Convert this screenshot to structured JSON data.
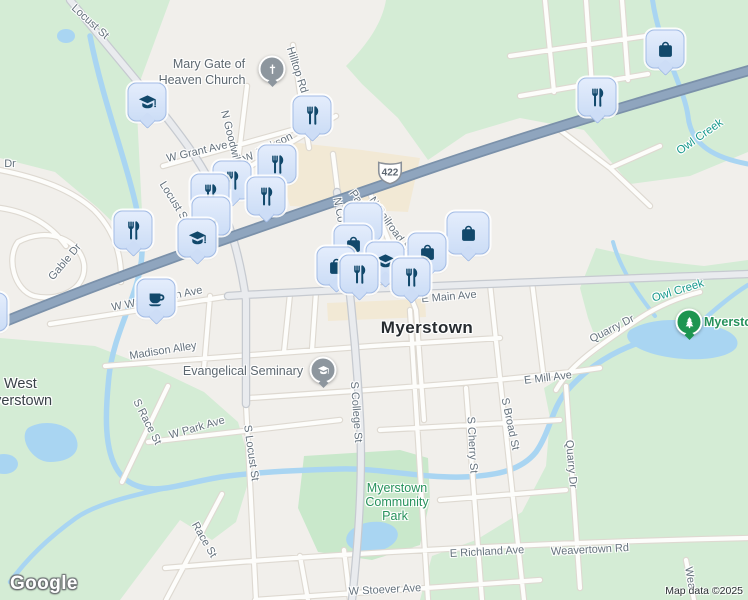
{
  "attribution": {
    "google": "Google",
    "map_data": "Map data ©2025"
  },
  "route_shield": {
    "number": "422",
    "x": 390,
    "y": 172
  },
  "colors": {
    "background": "#f1efeb",
    "green_area": "#d4ecd5",
    "park_area": "#c9e8cb",
    "water": "#a9d5f2",
    "commercial": "#f2e9d5",
    "highway_fill": "#8fa5be",
    "highway_casing": "#7b91aa",
    "marker_icon": "#11486b",
    "marker_fill": "#dbe6f9",
    "pin_gray": "#8d969e",
    "pin_green": "#1d9550",
    "street_label": "#64717c",
    "water_label": "#189a8d",
    "park_label": "#27925c",
    "city_label": "#272c30"
  },
  "labels": [
    {
      "text": "Locust St",
      "x": 90,
      "y": 22,
      "r": 42
    },
    {
      "text": "Hilltop Rd",
      "x": 297,
      "y": 70,
      "r": 72
    },
    {
      "text": "N Goodwill St",
      "x": 232,
      "y": 143,
      "r": 76
    },
    {
      "text": "W Grant Ave",
      "x": 197,
      "y": 152,
      "r": -13
    },
    {
      "text": "W Jackson",
      "x": 268,
      "y": 148,
      "r": -27
    },
    {
      "text": "Dr",
      "x": 10,
      "y": 164,
      "r": 0
    },
    {
      "text": "Locust St",
      "x": 174,
      "y": 202,
      "r": 58
    },
    {
      "text": "Gable Dr",
      "x": 65,
      "y": 262,
      "r": -50
    },
    {
      "text": "Park St",
      "x": 362,
      "y": 206,
      "r": 55
    },
    {
      "text": "N College St",
      "x": 342,
      "y": 228,
      "r": 80
    },
    {
      "text": "N Railroad St",
      "x": 390,
      "y": 225,
      "r": 55
    },
    {
      "text": "W Washington Ave",
      "x": 157,
      "y": 299,
      "r": -11
    },
    {
      "text": "Madison Alley",
      "x": 163,
      "y": 351,
      "r": -9
    },
    {
      "text": "E Main Ave",
      "x": 449,
      "y": 297,
      "r": -5
    },
    {
      "text": "S Race St",
      "x": 147,
      "y": 422,
      "r": 63
    },
    {
      "text": "W Park Ave",
      "x": 197,
      "y": 428,
      "r": -16
    },
    {
      "text": "S Locust St",
      "x": 251,
      "y": 453,
      "r": 82
    },
    {
      "text": "S College St",
      "x": 356,
      "y": 412,
      "r": 86
    },
    {
      "text": "S Cherry St",
      "x": 472,
      "y": 445,
      "r": 87
    },
    {
      "text": "S Broad St",
      "x": 510,
      "y": 424,
      "r": 78
    },
    {
      "text": "E Mill Ave",
      "x": 548,
      "y": 378,
      "r": -7
    },
    {
      "text": "Quarry Dr",
      "x": 612,
      "y": 329,
      "r": -27
    },
    {
      "text": "Quarry Dr",
      "x": 571,
      "y": 464,
      "r": 85
    },
    {
      "text": "E Richland Ave",
      "x": 487,
      "y": 552,
      "r": -3
    },
    {
      "text": "Weavertown Rd",
      "x": 590,
      "y": 550,
      "r": -3
    },
    {
      "text": "Wea",
      "x": 690,
      "y": 578,
      "r": 80
    },
    {
      "text": "W Stoever Ave",
      "x": 385,
      "y": 590,
      "r": -3
    },
    {
      "text": "Race St",
      "x": 204,
      "y": 540,
      "r": 60
    },
    {
      "text": "Owl Creek",
      "x": 700,
      "y": 137,
      "r": -35,
      "cls": "water"
    },
    {
      "text": "Owl Creek",
      "x": 678,
      "y": 291,
      "r": -17,
      "cls": "water"
    },
    {
      "text": "Myerstown",
      "x": 397,
      "y": 488,
      "r": 0,
      "cls": "park"
    },
    {
      "text": "Community",
      "x": 397,
      "y": 502,
      "r": 0,
      "cls": "park"
    },
    {
      "text": "Park",
      "x": 395,
      "y": 516,
      "r": 0,
      "cls": "park"
    },
    {
      "text": "Myerstown",
      "x": 704,
      "y": 322,
      "r": 0,
      "cls": "parkname",
      "a": "l"
    },
    {
      "text": "Myerstown",
      "x": 427,
      "y": 328,
      "r": 0,
      "cls": "city"
    },
    {
      "text": "West",
      "x": 4,
      "y": 384,
      "r": 0,
      "cls": "area",
      "a": "l"
    },
    {
      "text": "Myerstown",
      "x": -18,
      "y": 401,
      "r": 0,
      "cls": "area",
      "a": "l"
    },
    {
      "text": "Mary Gate of",
      "x": 209,
      "y": 64,
      "r": 0,
      "cls": "poi"
    },
    {
      "text": "Heaven Church",
      "x": 202,
      "y": 80,
      "r": 0,
      "cls": "poi"
    },
    {
      "text": "Evangelical Seminary",
      "x": 243,
      "y": 371,
      "r": 0,
      "cls": "poi"
    }
  ],
  "markers": [
    {
      "type": "bag",
      "x": 665,
      "y": 49
    },
    {
      "type": "restaurant",
      "x": 597,
      "y": 97
    },
    {
      "type": "school",
      "x": 147,
      "y": 102
    },
    {
      "type": "restaurant",
      "x": 312,
      "y": 115
    },
    {
      "type": "restaurant",
      "x": 277,
      "y": 164
    },
    {
      "type": "restaurant",
      "x": 232,
      "y": 180
    },
    {
      "type": "restaurant",
      "x": 210,
      "y": 193
    },
    {
      "type": "restaurant",
      "x": 266,
      "y": 196
    },
    {
      "type": "cart",
      "x": 211,
      "y": 216
    },
    {
      "type": "cart",
      "x": 363,
      "y": 222
    },
    {
      "type": "restaurant",
      "x": 133,
      "y": 230
    },
    {
      "type": "bag",
      "x": 468,
      "y": 233,
      "size": "lg"
    },
    {
      "type": "school",
      "x": 197,
      "y": 238
    },
    {
      "type": "bag",
      "x": 353,
      "y": 244
    },
    {
      "type": "bag",
      "x": 427,
      "y": 252
    },
    {
      "type": "school",
      "x": 385,
      "y": 261
    },
    {
      "type": "bag",
      "x": 336,
      "y": 266
    },
    {
      "type": "restaurant",
      "x": 359,
      "y": 274
    },
    {
      "type": "restaurant",
      "x": 411,
      "y": 277
    },
    {
      "type": "coffee",
      "x": 156,
      "y": 298
    },
    {
      "type": "bag",
      "x": -12,
      "y": 312
    }
  ],
  "pins": [
    {
      "type": "church",
      "x": 272,
      "y": 69
    },
    {
      "type": "school",
      "x": 323,
      "y": 370
    },
    {
      "type": "park",
      "x": 689,
      "y": 322
    }
  ]
}
